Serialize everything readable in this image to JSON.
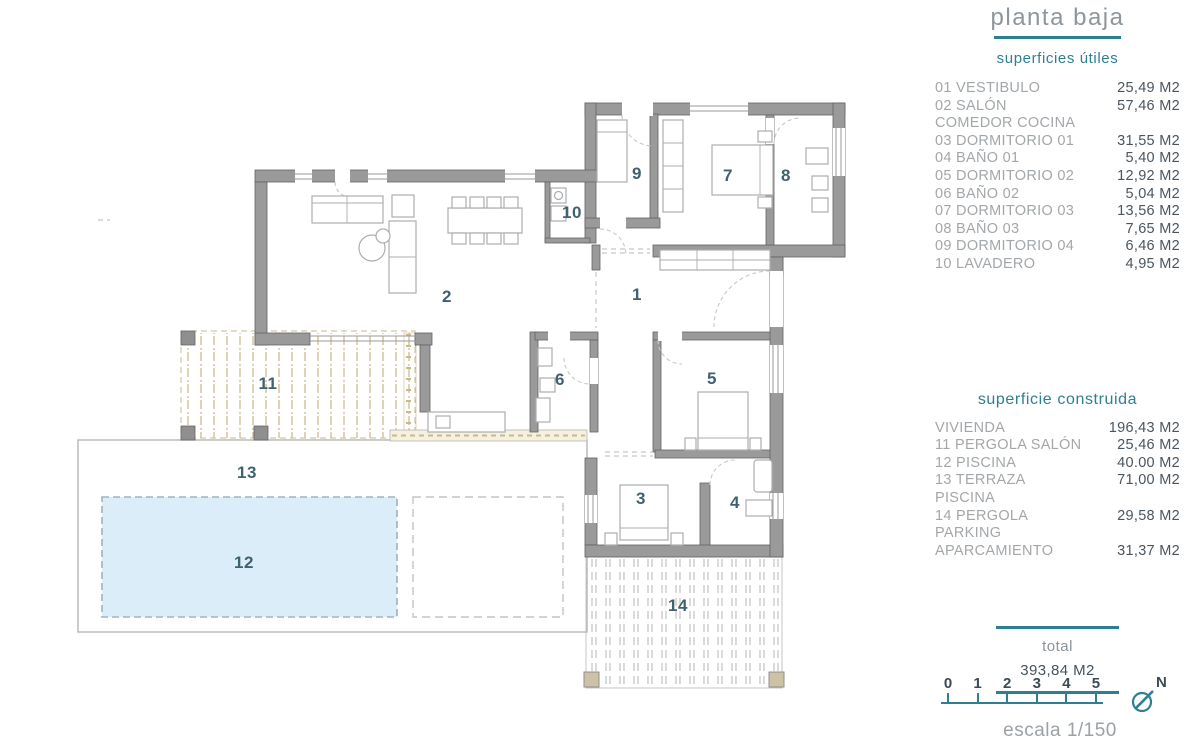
{
  "panel": {
    "title": "planta baja",
    "subtitle": "superficies útiles",
    "useful_areas": [
      {
        "label": "01 VESTIBULO",
        "value": "25,49 M2"
      },
      {
        "label": "02 SALÓN COMEDOR COCINA",
        "value": "57,46 M2"
      },
      {
        "label": "03 DORMITORIO 01",
        "value": "31,55 M2"
      },
      {
        "label": "04 BAÑO 01",
        "value": "5,40 M2"
      },
      {
        "label": "05 DORMITORIO 02",
        "value": "12,92 M2"
      },
      {
        "label": "06 BAÑO 02",
        "value": "5,04 M2"
      },
      {
        "label": "07 DORMITORIO 03",
        "value": "13,56 M2"
      },
      {
        "label": "08 BAÑO 03",
        "value": "7,65 M2"
      },
      {
        "label": "09 DORMITORIO 04",
        "value": "6,46 M2"
      },
      {
        "label": "10 LAVADERO",
        "value": "4,95 M2"
      }
    ],
    "built_heading": "superficie construida",
    "built_areas": [
      {
        "label": "VIVIENDA",
        "value": "196,43 M2"
      },
      {
        "label": "11 PERGOLA SALÓN",
        "value": "25,46 M2"
      },
      {
        "label": "12 PISCINA",
        "value": "40.00 M2"
      },
      {
        "label": "13 TERRAZA PISCINA",
        "value": "71,00 M2"
      },
      {
        "label": "14 PERGOLA PARKING",
        "value": "29,58 M2"
      },
      {
        "label": "APARCAMIENTO",
        "value": "31,37 M2"
      }
    ],
    "total_label": "total",
    "total_value": "393,84 M2"
  },
  "scalebar": {
    "ticks": [
      "0",
      "1",
      "2",
      "3",
      "4",
      "5"
    ],
    "label": "escala 1/150",
    "north": "N"
  },
  "plan": {
    "rooms": [
      {
        "number": "1"
      },
      {
        "number": "2"
      },
      {
        "number": "3"
      },
      {
        "number": "4"
      },
      {
        "number": "5"
      },
      {
        "number": "6"
      },
      {
        "number": "7"
      },
      {
        "number": "8"
      },
      {
        "number": "9"
      },
      {
        "number": "10"
      },
      {
        "number": "11"
      },
      {
        "number": "12"
      },
      {
        "number": "13"
      },
      {
        "number": "14"
      }
    ]
  },
  "colors": {
    "teal": "#2e8090",
    "wall_gray": "#9a9a9a",
    "pool_fill": "#daedf8",
    "pergola_tan": "#cbb990",
    "room_number": "#3f626f"
  }
}
